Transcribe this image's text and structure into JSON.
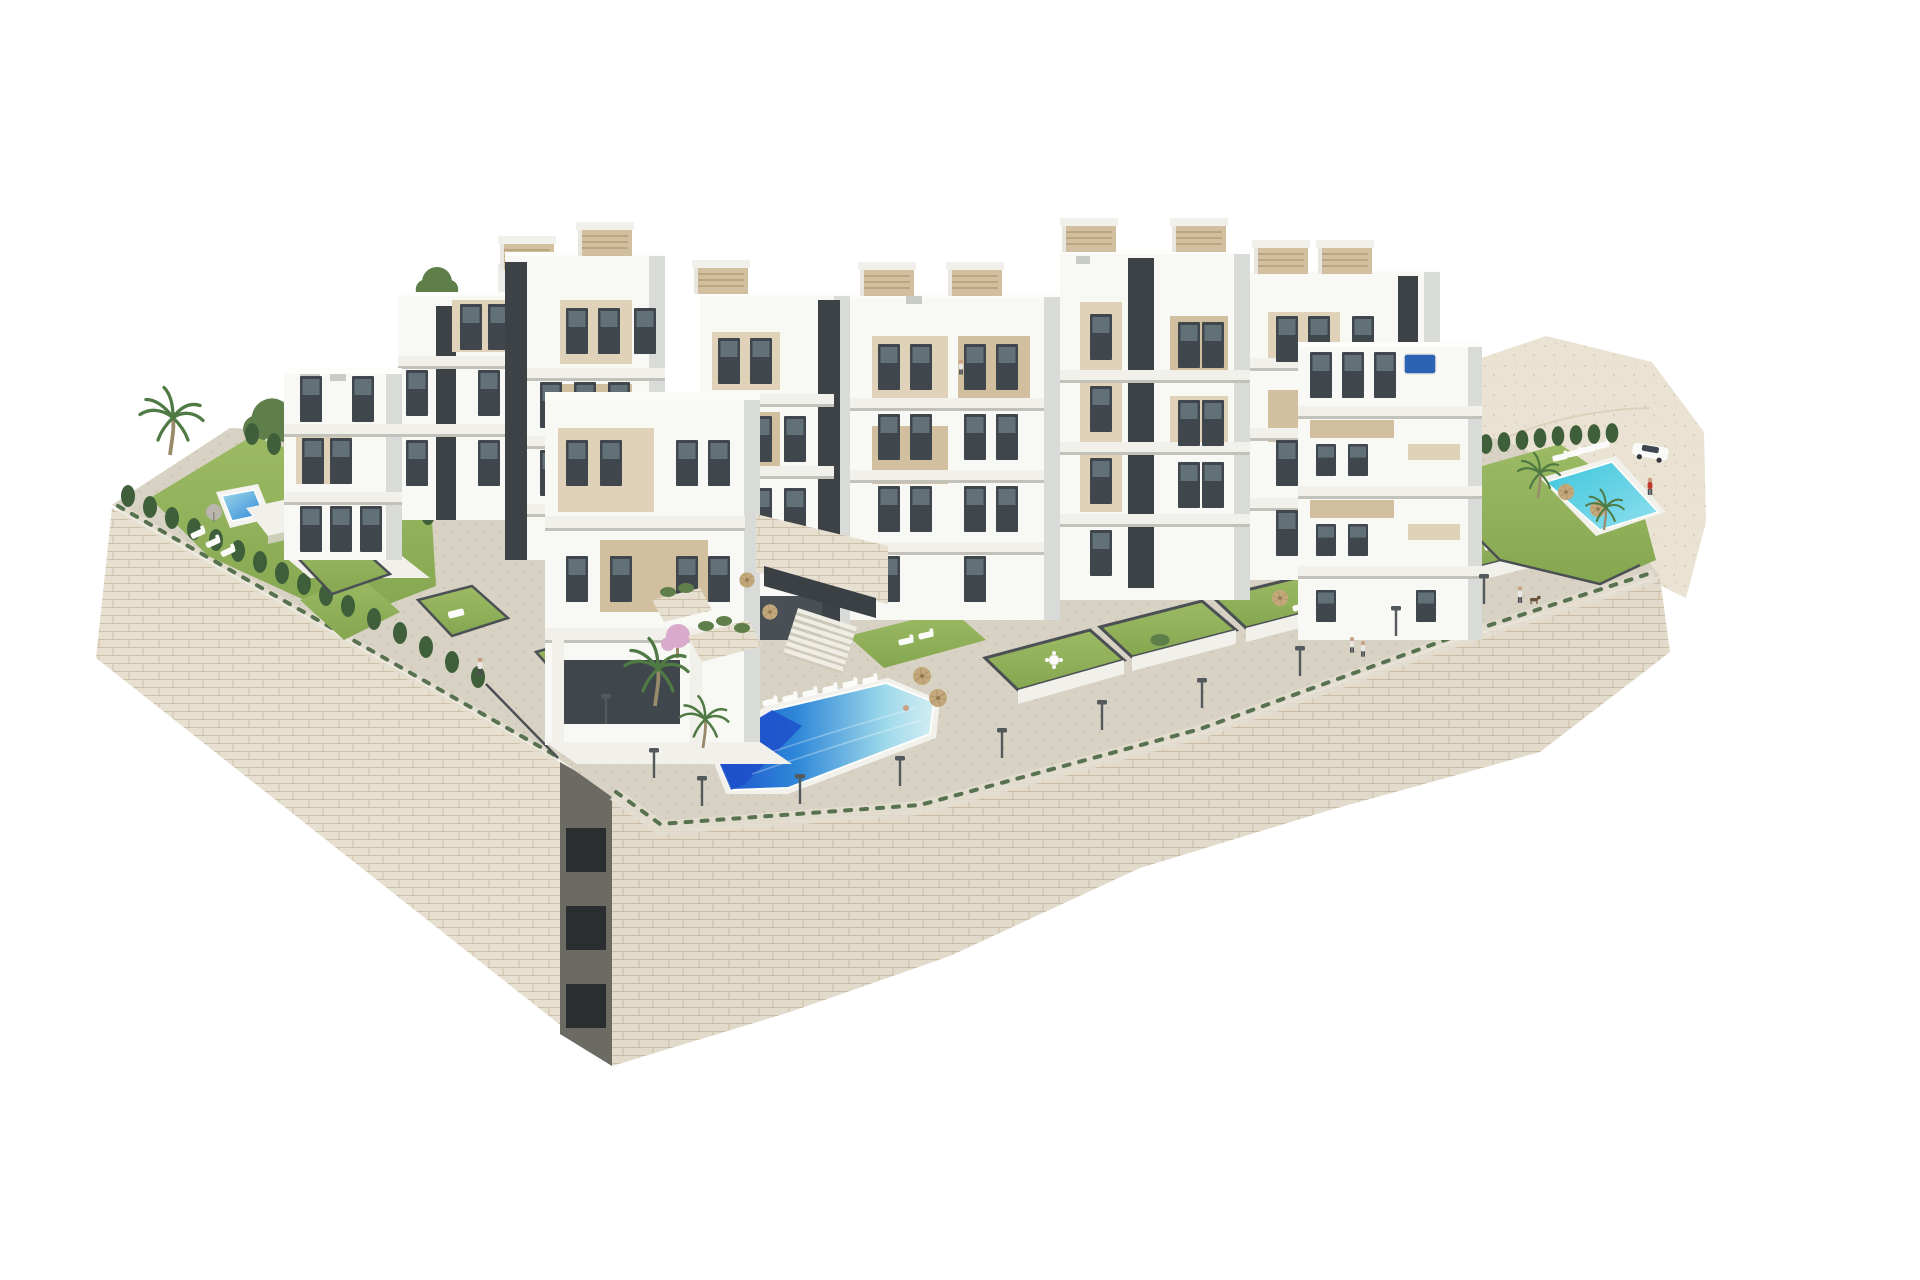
{
  "scene": {
    "alt_text": "Aerial 3D architectural rendering of a white terraced apartment complex with beige accents, rooftop pergolas, private lawn gardens, three swimming pools and cream stone retaining walls, isolated on a white background",
    "background": "#ffffff"
  },
  "features": {
    "building_blocks": 9,
    "swimming_pools": 3,
    "rooftop_pergolas": 10,
    "private_lawns": 10,
    "street_lamps": 11,
    "palm_trees": 6,
    "cars": 1,
    "people": 6,
    "staircases": 2
  },
  "colors": {
    "white_lit": "#f8f8f5",
    "white_mid": "#ecece9",
    "white_shade": "#d9dbd9",
    "parapet": "#f1f0ea",
    "beige": "#d2bfa0",
    "beige_light": "#e0d2b8",
    "core_dark": "#3d4246",
    "window": "#3f474d",
    "window_light": "#8ea2ac",
    "stone": "#e7e0d1",
    "stone_joint": "#cdc0a8",
    "pavement": "#d8d2c4",
    "pavement_dot": "#c4bcab",
    "terrain": "#eae2d2",
    "terrain_dot": "#d7cab2",
    "lawn": "#85a750",
    "lawn_light": "#9cba64",
    "hedge": "#3f5f3a",
    "shrub": "#5e7f4a",
    "palm": "#4f7a43",
    "trunk": "#9a8a6c",
    "blossom": "#d9aacb",
    "pool_deep": "#1d4ecb",
    "pool_mid": "#2e87d8",
    "pool_light": "#9ed9ea",
    "pool_foam": "#d3eef3",
    "pool_teal": "#3ec5dc",
    "pool_teal_light": "#8fe0ee",
    "parasol": "#c3a87c",
    "lounger": "#fbfbf9",
    "fence": "#4b5054",
    "lamp": "#54595d",
    "skin": "#caa184",
    "car_body": "#fafaf8",
    "car_glass": "#3d4750",
    "shadow": "#b5b0a2"
  }
}
